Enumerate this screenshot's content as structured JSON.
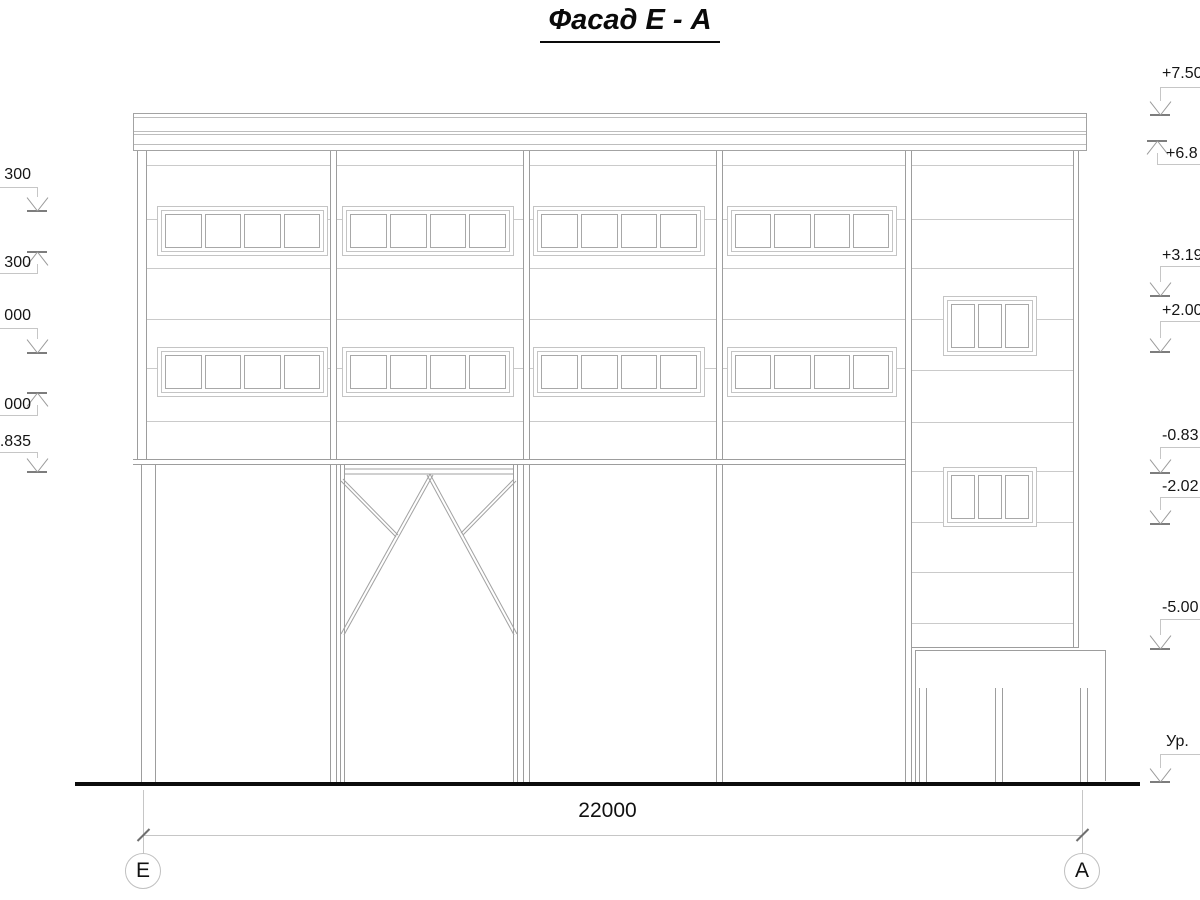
{
  "title": "Фасад Е - А",
  "dimension": {
    "total_width": "22000"
  },
  "axes": {
    "left": "Е",
    "right": "А"
  },
  "elevations": {
    "left": [
      "300",
      "300",
      "000",
      "000",
      ".835"
    ],
    "right": [
      "+7.50",
      "+6.8",
      "+3.19",
      "+2.00",
      "-0.83",
      "-2.02",
      "-5.00",
      "Ур."
    ]
  },
  "colors": {
    "structural_line": "#9d9d9d",
    "light_line": "#cacaca",
    "ink": "#111111",
    "ground_line": "#0c0c0c"
  }
}
